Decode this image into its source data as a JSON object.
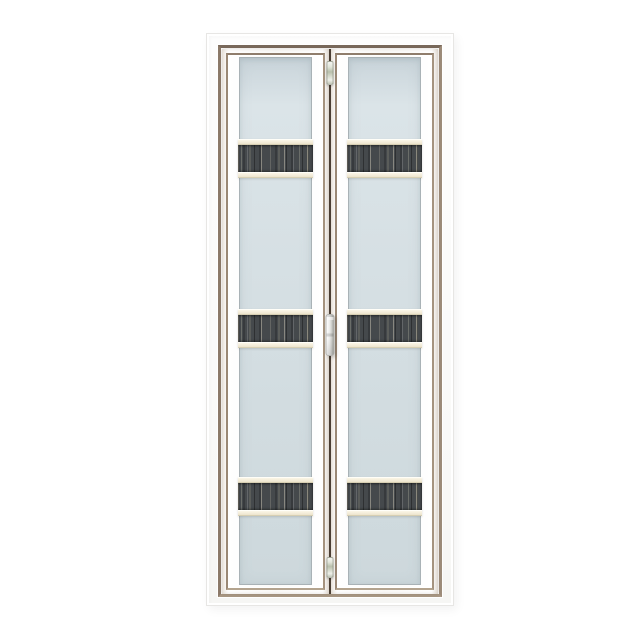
{
  "image": {
    "type": "product-photo",
    "subject": "white aluminium bi-fold door with frosted glass panels and dark wood-grain decorative strips",
    "background_color": "#ffffff"
  },
  "door": {
    "leaf_count": 2,
    "strip_count_per_leaf": 3,
    "colors": {
      "background": "#ffffff",
      "frame": "#fbfbfa",
      "frame_trim": "#8c7a6a",
      "leaf_face": "#fbfaf8",
      "leaf_bevel": "#9a8875",
      "glass_top": "#dbe4e8",
      "glass_mid": "#d4dee2",
      "glass_bottom": "#cdd8dc",
      "glass_deep_edge": "#c9d4da",
      "rail_cream": "#f3ecd8",
      "strip_dark": "#45494c",
      "strip_streak_light": "#a5a798",
      "strip_streak_tan": "#ece4cd",
      "center_gap": "#4a3e33",
      "hardware_silver": "#d9dcd2"
    },
    "decor_rows": [
      {
        "top": 90
      },
      {
        "top": 260
      },
      {
        "top": 428
      }
    ],
    "hardware": [
      {
        "kind": "hinge",
        "name": "top-hinge",
        "top": 12,
        "height": 24
      },
      {
        "kind": "handle",
        "name": "door-handle",
        "top": 265,
        "height": 42
      },
      {
        "kind": "hinge",
        "name": "bottom-hinge",
        "top": 508,
        "height": 21
      }
    ]
  }
}
